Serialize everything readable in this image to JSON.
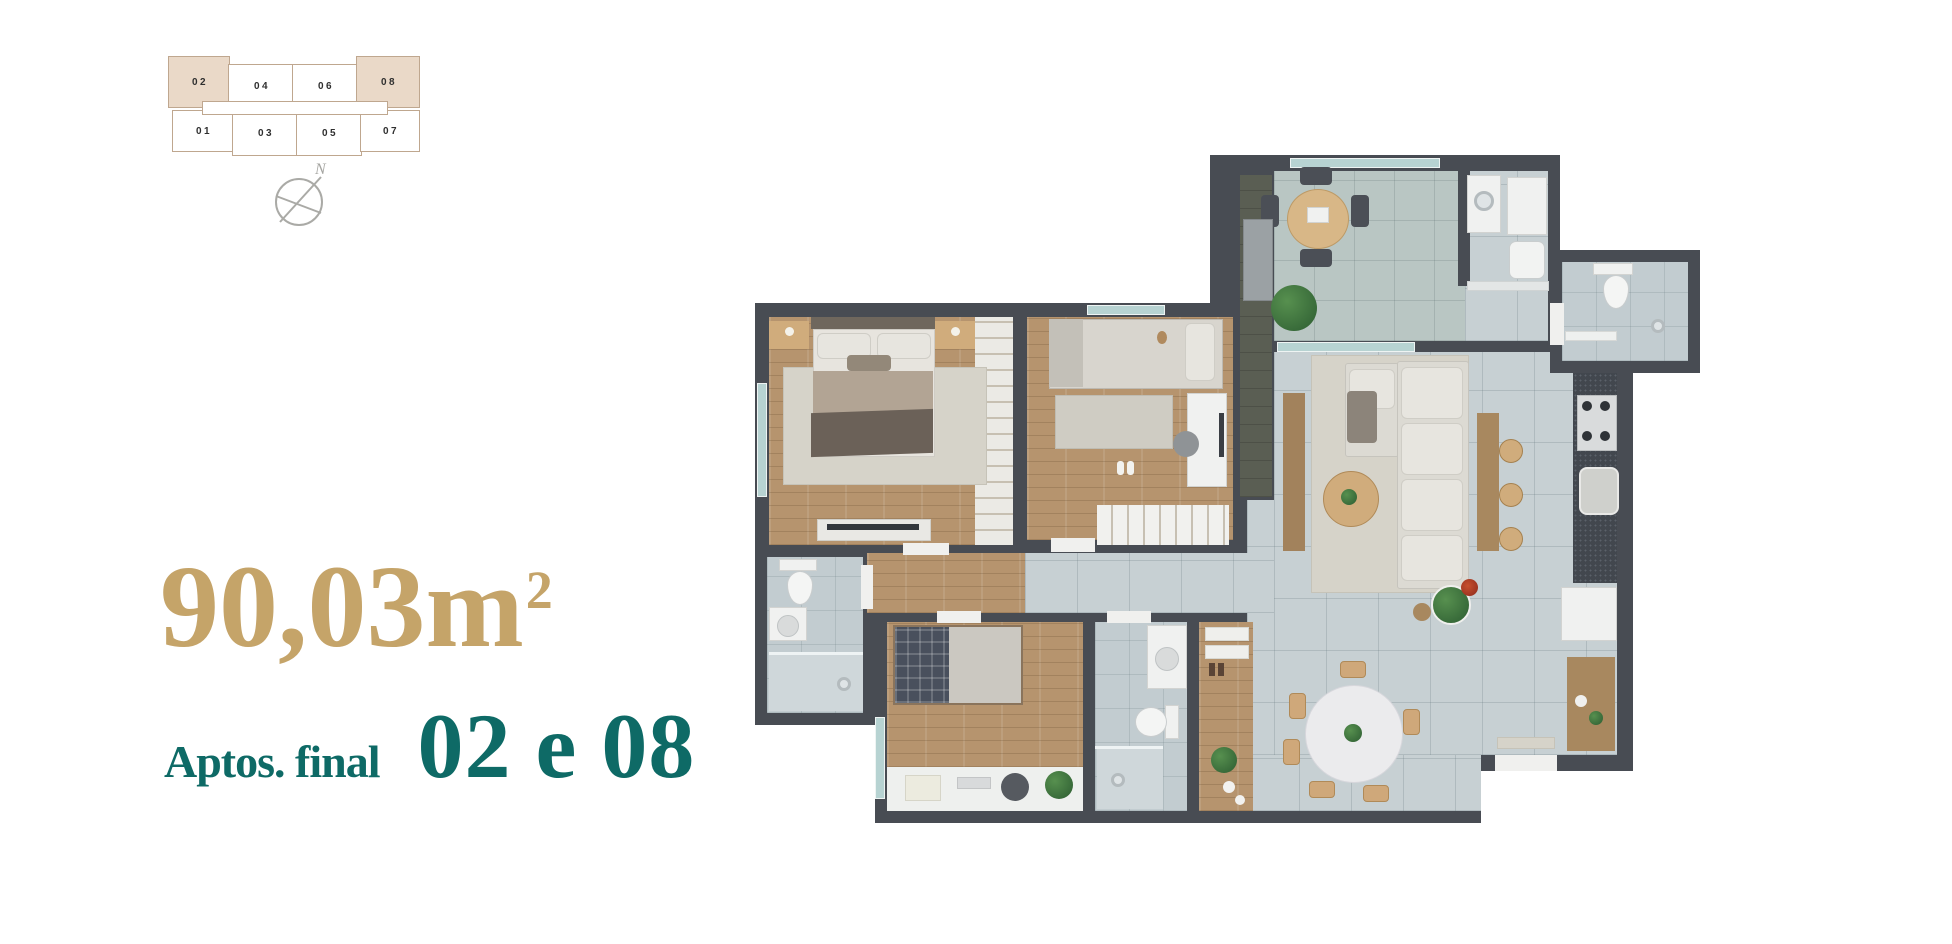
{
  "keyplan": {
    "units": [
      {
        "label": "02",
        "highlighted": true
      },
      {
        "label": "04",
        "highlighted": false
      },
      {
        "label": "06",
        "highlighted": false
      },
      {
        "label": "08",
        "highlighted": true
      },
      {
        "label": "01",
        "highlighted": false
      },
      {
        "label": "03",
        "highlighted": false
      },
      {
        "label": "05",
        "highlighted": false
      },
      {
        "label": "07",
        "highlighted": false
      }
    ]
  },
  "compass": {
    "north_label": "N"
  },
  "area": {
    "value": "90,03",
    "unit": "m",
    "superscript": "2"
  },
  "caption": {
    "prefix": "Aptos. final",
    "units_text": "02 e 08"
  },
  "colors": {
    "accent_gold": "#c5a469",
    "accent_teal": "#0e6a66",
    "wall": "#484c53",
    "keyplan_line": "#bfa78f",
    "keyplan_highlight": "#ead9c8"
  }
}
